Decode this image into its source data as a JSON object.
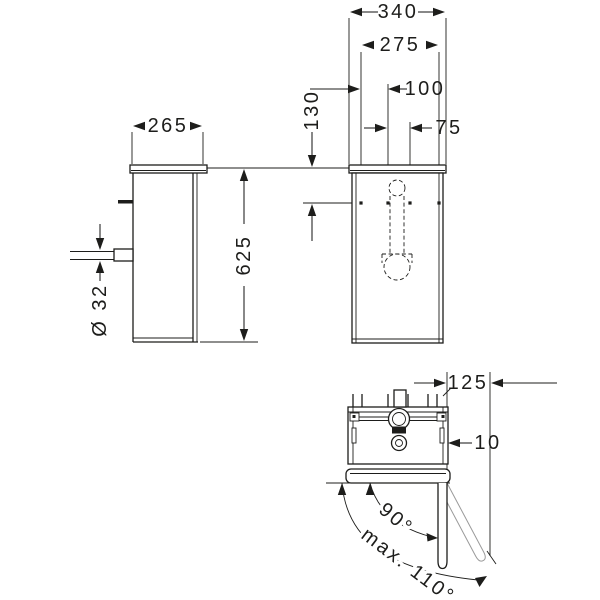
{
  "drawing_type": "technical-dimension-drawing",
  "colors": {
    "line": "#1d1d1b",
    "light_line": "#9a9a9a",
    "background": "#ffffff"
  },
  "views": {
    "front": {
      "dims": {
        "overall_width": "340",
        "fixing_width": "275",
        "fixing_spacing_left": "100",
        "fixing_spacing_right": "75",
        "top_distance": "130"
      }
    },
    "side": {
      "dims": {
        "depth": "265",
        "height": "625",
        "drain_diameter": "Ø 32"
      }
    },
    "top": {
      "dims": {
        "side_distance": "125",
        "wall_gap": "10",
        "opening_angle": "90°",
        "opening_angle_max": "max. 110°"
      }
    }
  }
}
